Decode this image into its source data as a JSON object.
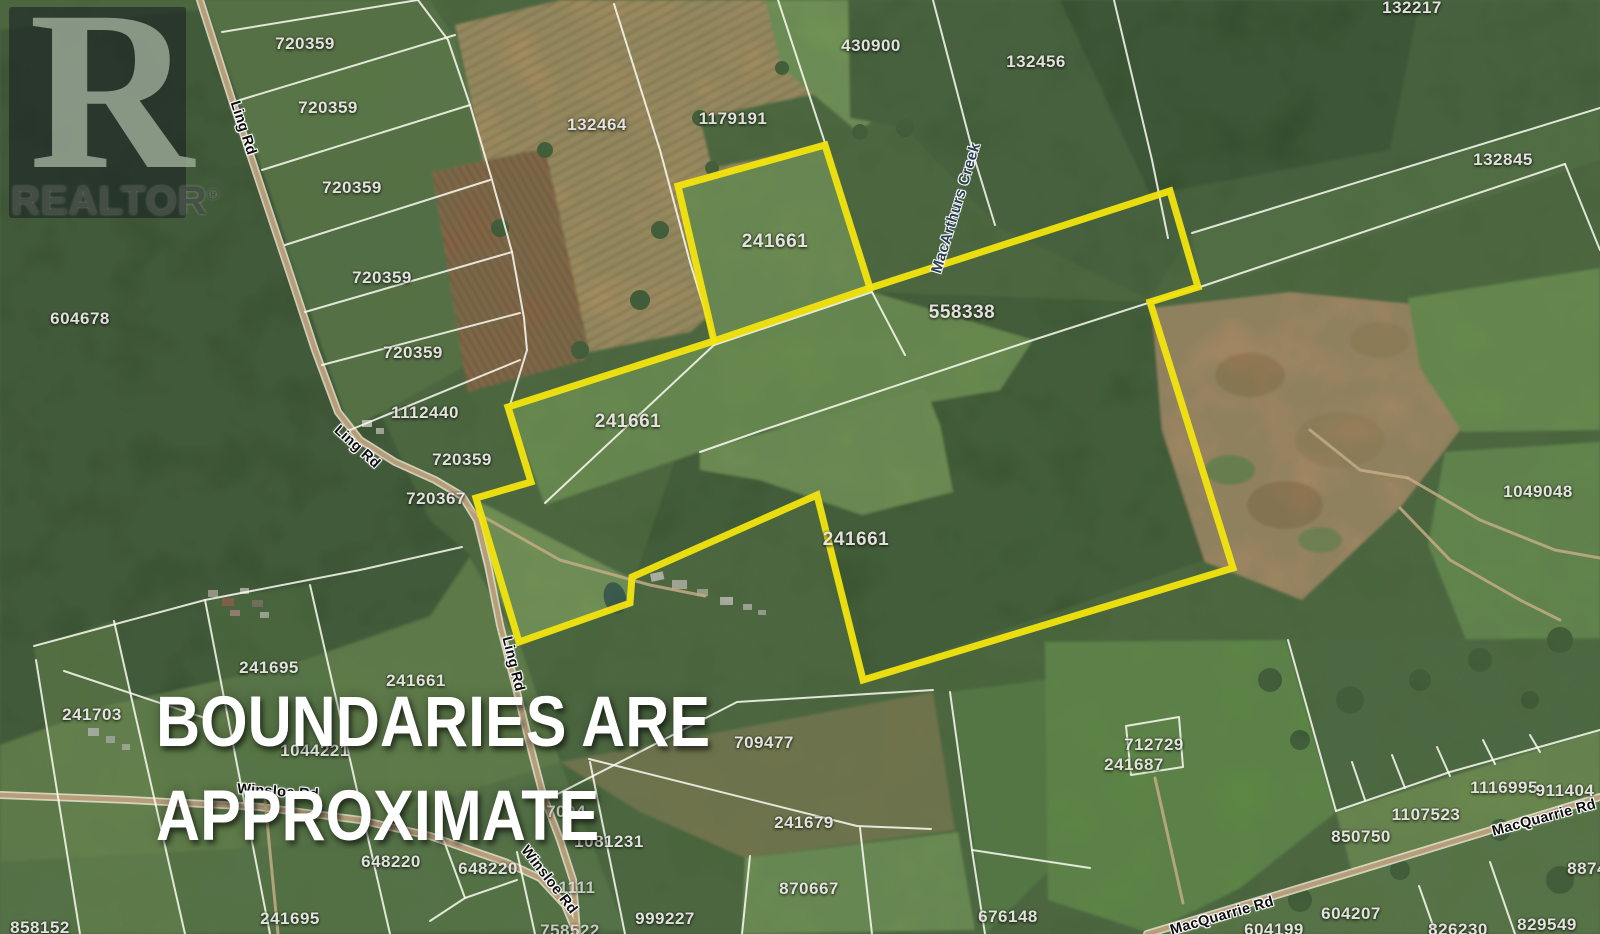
{
  "watermark": {
    "logo_letter": "R",
    "brand": "REALTOR",
    "registered": "®"
  },
  "disclaimer": {
    "line1": "BOUNDARIES ARE",
    "line2": "APPROXIMATE"
  },
  "colors": {
    "boundary_highlight": "#f2e40e",
    "parcel_line": "#fbfbf2",
    "road_core": "#b59a74",
    "road_casing": "#f0ead8",
    "label_text": "#e9e9e3",
    "road_label_text": "#0d0d0d",
    "creek_label_text": "#2a3d55",
    "disclaimer_text": "#ffffff"
  },
  "boundary": {
    "square": "678,186 825,145 870,288 714,341",
    "main": "870,288 1170,191 1198,287 1150,302 1233,568 863,680 817,495 632,577 630,603 519,642 476,498 531,482 508,407 714,341"
  },
  "parcel_lines": [
    "222,32 418,0",
    "240,100 455,35",
    "262,170 470,105",
    "285,245 490,180",
    "305,312 512,252",
    "322,365 520,313",
    "350,430 520,360",
    "418,0 448,40 470,105 492,180 512,252 524,318 527,350 510,405",
    "614,4 660,150 690,262 714,341",
    "778,0 825,143",
    "933,0 975,160 995,225",
    "1114,0 1152,160 1168,238",
    "1192,233 1600,108",
    "1200,287 1565,164",
    "1565,164 1600,250",
    "545,503 714,345",
    "714,345 872,292",
    "1198,287 1033,340 760,431 700,452",
    "872,292 905,355",
    "34,646 205,600 360,570 462,547",
    "36,660 80,934",
    "114,621 185,934",
    "205,600 270,934",
    "310,585 390,934",
    "437,822 465,898 430,921",
    "465,898 517,880",
    "517,852 535,934",
    "64,671 205,718",
    "550,798 737,702 933,690",
    "589,759 857,826 931,829",
    "860,828 872,934",
    "950,692 972,850 985,934",
    "972,850 1090,868",
    "750,856 742,934",
    "590,762 625,934",
    "1288,640 1336,811",
    "1336,811 1450,772 1600,730",
    "1126,726 1179,717 1183,767 1131,775 1126,726",
    "1365,800 1352,762",
    "1405,788 1392,755",
    "1450,776 1437,747",
    "1495,764 1483,740",
    "1540,752 1530,735",
    "1419,886 1436,934",
    "1490,862 1515,934"
  ],
  "roads": [
    "200,0 232,100 262,190 292,280 315,350 338,412 360,440 395,462 435,480 462,496 477,520 488,565 500,625 516,688 530,745 543,795 560,840 573,880 577,934",
    "0,795 130,800 260,807 360,820 430,836 470,850 505,862 540,878 565,905 577,934",
    "1147,934 1350,873 1600,797"
  ],
  "lanes": [
    "468,508 560,560 650,585 705,596",
    "265,800 278,934",
    "1155,778 1183,903",
    "1408,478 1480,520 1555,550 1600,558",
    "1310,430 1360,470 1408,478",
    "1400,508 1450,560 1520,600 1560,620"
  ],
  "parcel_labels": [
    {
      "text": "720359",
      "x": 305,
      "y": 44
    },
    {
      "text": "720359",
      "x": 328,
      "y": 108
    },
    {
      "text": "720359",
      "x": 352,
      "y": 188
    },
    {
      "text": "720359",
      "x": 382,
      "y": 278
    },
    {
      "text": "604678",
      "x": 80,
      "y": 319
    },
    {
      "text": "720359",
      "x": 413,
      "y": 353
    },
    {
      "text": "1112440",
      "x": 425,
      "y": 413
    },
    {
      "text": "720359",
      "x": 462,
      "y": 460
    },
    {
      "text": "720367",
      "x": 436,
      "y": 499
    },
    {
      "text": "132464",
      "x": 597,
      "y": 125
    },
    {
      "text": "1179191",
      "x": 733,
      "y": 119
    },
    {
      "text": "430900",
      "x": 871,
      "y": 46
    },
    {
      "text": "132456",
      "x": 1036,
      "y": 62
    },
    {
      "text": "132217",
      "x": 1412,
      "y": 8
    },
    {
      "text": "132845",
      "x": 1503,
      "y": 160
    },
    {
      "text": "241661",
      "x": 775,
      "y": 242,
      "big": true
    },
    {
      "text": "558338",
      "x": 962,
      "y": 313,
      "big": true
    },
    {
      "text": "241661",
      "x": 628,
      "y": 422,
      "big": true
    },
    {
      "text": "241661",
      "x": 856,
      "y": 540,
      "big": true
    },
    {
      "text": "1049048",
      "x": 1538,
      "y": 492
    },
    {
      "text": "241695",
      "x": 269,
      "y": 668
    },
    {
      "text": "241661",
      "x": 416,
      "y": 681
    },
    {
      "text": "241703",
      "x": 92,
      "y": 715
    },
    {
      "text": "1044221",
      "x": 315,
      "y": 751
    },
    {
      "text": "709477",
      "x": 764,
      "y": 743
    },
    {
      "text": "1081231",
      "x": 609,
      "y": 842
    },
    {
      "text": "241679",
      "x": 804,
      "y": 823
    },
    {
      "text": "870667",
      "x": 809,
      "y": 889
    },
    {
      "text": "999227",
      "x": 665,
      "y": 919
    },
    {
      "text": "676148",
      "x": 1008,
      "y": 917
    },
    {
      "text": "648220",
      "x": 391,
      "y": 862
    },
    {
      "text": "648220",
      "x": 488,
      "y": 869
    },
    {
      "text": "241695",
      "x": 290,
      "y": 919
    },
    {
      "text": "858152",
      "x": 40,
      "y": 928
    },
    {
      "text": "712729",
      "x": 1154,
      "y": 745
    },
    {
      "text": "241687",
      "x": 1134,
      "y": 765
    },
    {
      "text": "1116995",
      "x": 1504,
      "y": 788
    },
    {
      "text": "911404",
      "x": 1565,
      "y": 791
    },
    {
      "text": "1107523",
      "x": 1426,
      "y": 815
    },
    {
      "text": "850750",
      "x": 1361,
      "y": 837
    },
    {
      "text": "604207",
      "x": 1351,
      "y": 914
    },
    {
      "text": "604199",
      "x": 1274,
      "y": 930
    },
    {
      "text": "826230",
      "x": 1458,
      "y": 930
    },
    {
      "text": "829549",
      "x": 1547,
      "y": 925
    },
    {
      "text": "887499",
      "x": 1597,
      "y": 869
    },
    {
      "text": "1111",
      "x": 577,
      "y": 888,
      "dim": true
    },
    {
      "text": "7094",
      "x": 566,
      "y": 812,
      "dim": true
    },
    {
      "text": "758522",
      "x": 570,
      "y": 931,
      "dim": true
    }
  ],
  "road_labels": [
    {
      "text": "Ling Rd",
      "x": 243,
      "y": 128,
      "rot": 72
    },
    {
      "text": "Ling Rd",
      "x": 357,
      "y": 447,
      "rot": 42
    },
    {
      "text": "Ling Rd",
      "x": 513,
      "y": 664,
      "rot": 76
    },
    {
      "text": "Winsloe Rd",
      "x": 278,
      "y": 792,
      "rot": 4
    },
    {
      "text": "Winsloe Rd",
      "x": 549,
      "y": 880,
      "rot": 52
    },
    {
      "text": "MacQuarrie Rd",
      "x": 1222,
      "y": 916,
      "rot": -16
    },
    {
      "text": "MacQuarrie Rd",
      "x": 1544,
      "y": 818,
      "rot": -15
    }
  ],
  "water_labels": [
    {
      "text": "MacArthurs Creek",
      "x": 956,
      "y": 208,
      "rot": -73
    }
  ]
}
